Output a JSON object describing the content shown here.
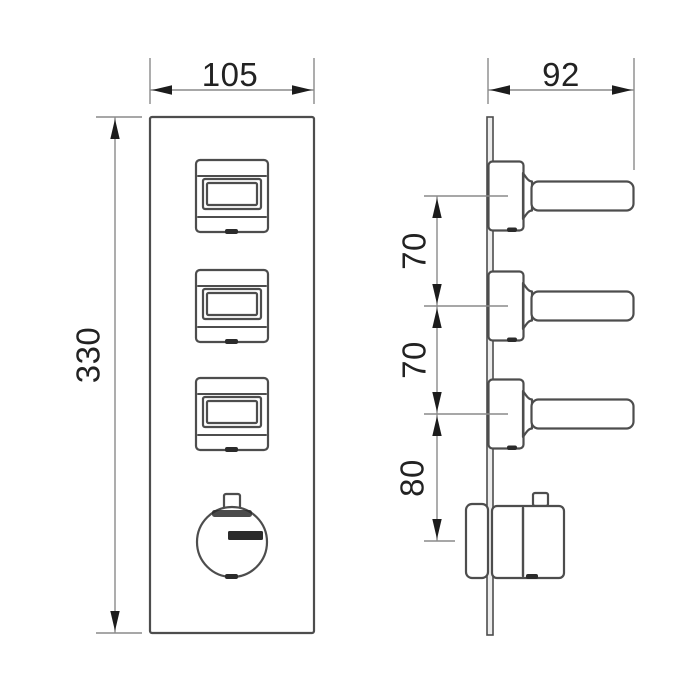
{
  "drawing": {
    "description": "Technical dimension drawing: 3-handle concealed thermostatic shower valve trim, front elevation and side elevation",
    "views": {
      "front": "front-elevation",
      "side": "side-elevation"
    }
  },
  "dims": {
    "front_width": "105",
    "front_height": "330",
    "side_depth": "92",
    "lever_gap_1": "70",
    "lever_gap_2": "70",
    "knob_gap": "80"
  },
  "marks": {
    "knob_top": "temperature-scale-mark",
    "knob_center": "brand-label-bar",
    "handle_bottom": "index-notch"
  },
  "colors": {
    "background": "#ffffff",
    "outline": "#4d4d4d",
    "plate_fill": "#ededed",
    "dimension_line": "#8a8a8a",
    "arrow": "#1c1c1c",
    "text": "#222222",
    "mark_fill": "#2b2b2b"
  }
}
